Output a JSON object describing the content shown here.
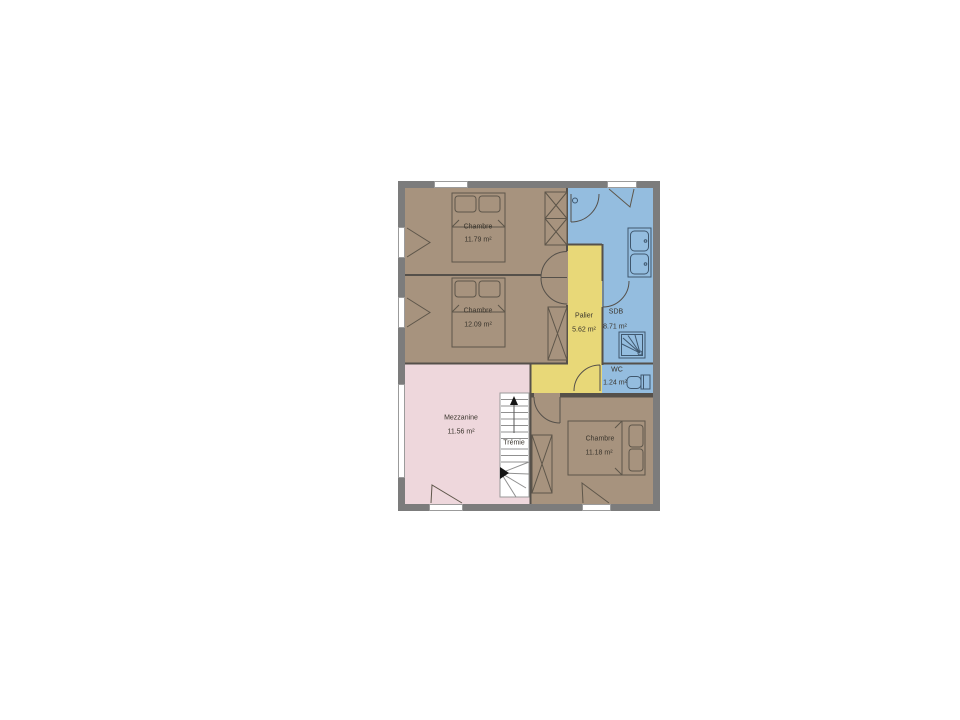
{
  "plan": {
    "rooms": {
      "chambre1": {
        "name": "Chambre",
        "area": "11.79 m²"
      },
      "chambre2": {
        "name": "Chambre",
        "area": "12.09 m²"
      },
      "palier": {
        "name": "Palier",
        "area": "5.62 m²"
      },
      "sdb": {
        "name": "SDB",
        "area": "8.71 m²"
      },
      "wc": {
        "name": "WC",
        "area": "1.24 m²"
      },
      "mezzanine": {
        "name": "Mezzanine",
        "area": "11.56 m²"
      },
      "chambre3": {
        "name": "Chambre",
        "area": "11.18 m²"
      },
      "stairwell": {
        "name": "Trémie"
      }
    },
    "colors": {
      "bedroom_fill": "#a7937e",
      "bathroom_fill": "#94bddf",
      "landing_fill": "#e8d878",
      "mezzanine_fill": "#eed7dc",
      "wall": "#7c7c7c"
    }
  }
}
